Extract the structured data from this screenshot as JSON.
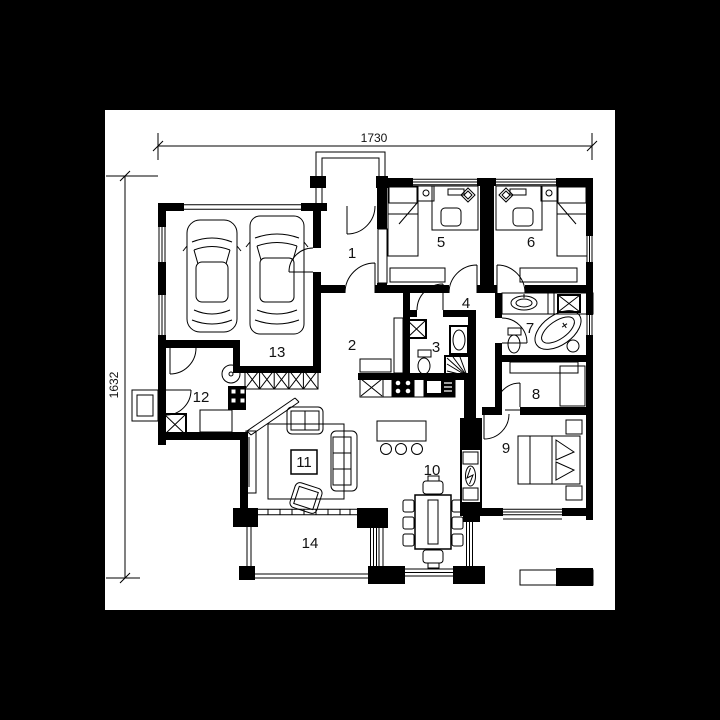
{
  "scene": {
    "background_color": "#000000",
    "sheet_color": "#ffffff",
    "ink_color": "#000000",
    "drawing_type_visible": "house floor plan"
  },
  "dimensions": {
    "horizontal": "1730",
    "vertical": "1632"
  },
  "rooms": [
    {
      "number": "1"
    },
    {
      "number": "2"
    },
    {
      "number": "3"
    },
    {
      "number": "4"
    },
    {
      "number": "5"
    },
    {
      "number": "6"
    },
    {
      "number": "7"
    },
    {
      "number": "8"
    },
    {
      "number": "9"
    },
    {
      "number": "10"
    },
    {
      "number": "11"
    },
    {
      "number": "12"
    },
    {
      "number": "13"
    },
    {
      "number": "14"
    }
  ],
  "symbols": [
    "car",
    "car",
    "bed",
    "bed",
    "double-bed",
    "desk",
    "desk-chair",
    "bathtub",
    "toilet",
    "washbasin",
    "shower",
    "washing-machine",
    "kitchen-counter",
    "stove",
    "sink",
    "refrigerator",
    "kitchen-island",
    "bar-stool",
    "dining-table",
    "dining-chair",
    "sofa",
    "armchair",
    "coffee-table",
    "rug",
    "tv-board",
    "wardrobe",
    "boiler",
    "furnace",
    "fireplace",
    "radiator",
    "window",
    "door",
    "terrace",
    "porch",
    "steps"
  ]
}
